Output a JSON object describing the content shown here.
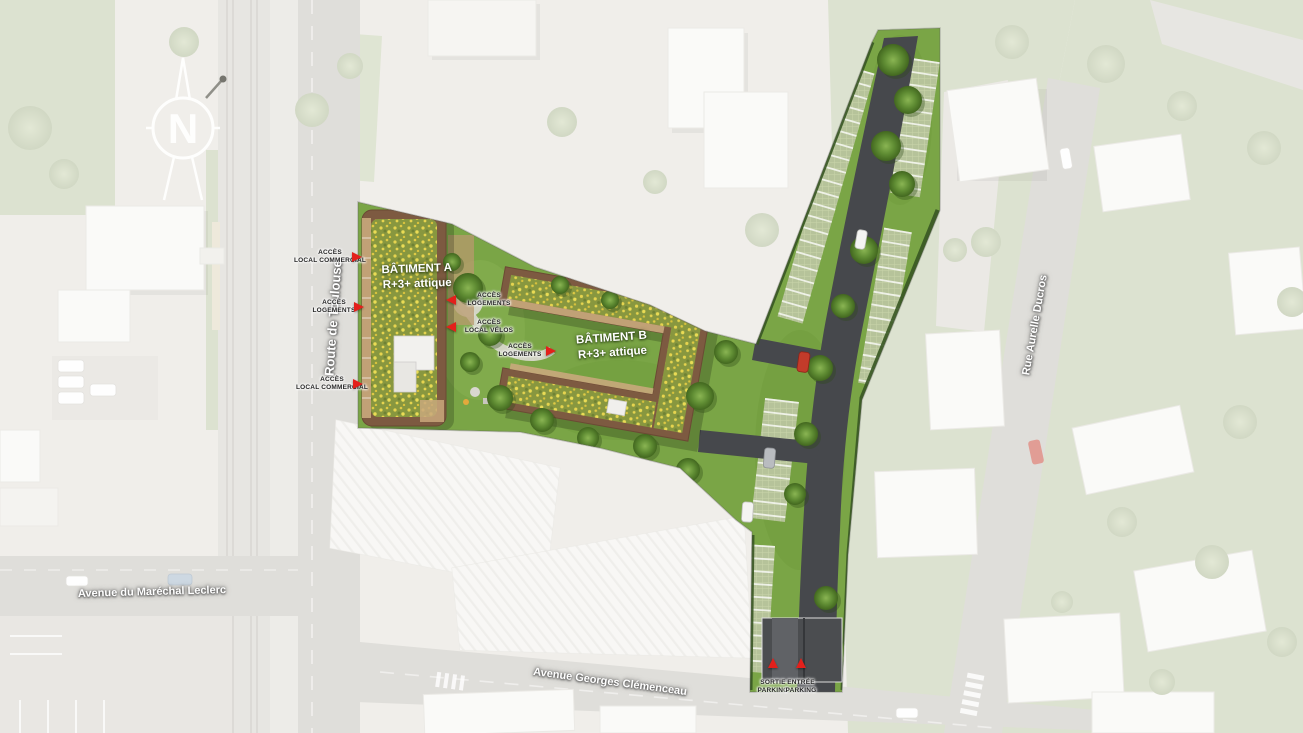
{
  "compass": {
    "letter": "N"
  },
  "streets": {
    "route_de_toulouse": "Route de Toulouse",
    "avenue_marechal_leclerc": "Avenue du Maréchal Leclerc",
    "avenue_georges_clemenceau": "Avenue Georges Clémenceau",
    "rue_aurelle_ducros": "Rue Aurelle Ducros"
  },
  "buildings": {
    "a": {
      "name": "BÂTIMENT A",
      "levels": "R+3+ attique"
    },
    "b": {
      "name": "BÂTIMENT B",
      "levels": "R+3+ attique"
    }
  },
  "access": [
    {
      "line1": "ACCÈS",
      "line2": "LOCAL COMMERCIAL"
    },
    {
      "line1": "ACCÈS",
      "line2": "LOGEMENTS"
    },
    {
      "line1": "ACCÈS",
      "line2": "LOCAL COMMERCIAL"
    },
    {
      "line1": "ACCÈS",
      "line2": "LOGEMENTS"
    },
    {
      "line1": "ACCÈS",
      "line2": "LOCAL VÉLOS"
    },
    {
      "line1": "ACCÈS",
      "line2": "LOGEMENTS"
    },
    {
      "line1": "SORTIE",
      "line2": "PARKING"
    },
    {
      "line1": "ENTRÉE",
      "line2": "PARKING"
    }
  ],
  "colors": {
    "site_grass": "#7aa546",
    "roof_green": "#88973f",
    "roof_flowers": "#e6d44f",
    "asphalt": "#46484c",
    "accent_red": "#e3201b",
    "faded_background": "#e0ddd5"
  }
}
